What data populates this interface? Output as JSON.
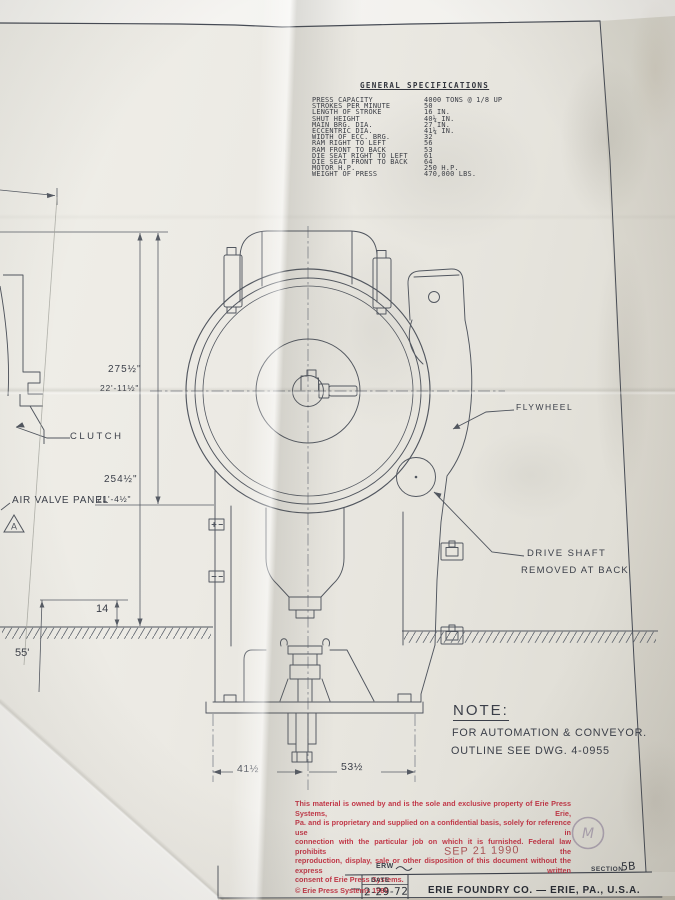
{
  "colors": {
    "paper": "#eceae4",
    "ink": "#4d525c",
    "legal_red": "#c23848",
    "stamp_red": "#a84a4c"
  },
  "specs": {
    "title": "GENERAL SPECIFICATIONS",
    "rows": [
      {
        "label": "PRESS CAPACITY",
        "value": "4000 TONS @ 1/8 UP"
      },
      {
        "label": "STROKES PER MINUTE",
        "value": "50"
      },
      {
        "label": "LENGTH OF STROKE",
        "value": "16 IN."
      },
      {
        "label": "SHUT HEIGHT",
        "value": "40¼ IN."
      },
      {
        "label": "MAIN BRG. DIA.",
        "value": "27 IN."
      },
      {
        "label": "ECCENTRIC DIA.",
        "value": "41¼ IN."
      },
      {
        "label": "WIDTH OF ECC. BRG.",
        "value": "32"
      },
      {
        "label": "RAM  RIGHT TO LEFT",
        "value": "56"
      },
      {
        "label": "RAM  FRONT TO BACK",
        "value": "53"
      },
      {
        "label": "DIE SEAT  RIGHT TO LEFT",
        "value": "61"
      },
      {
        "label": "DIE SEAT  FRONT TO BACK",
        "value": "64"
      },
      {
        "label": "MOTOR  H.P.",
        "value": "250 H.P."
      },
      {
        "label": "WEIGHT OF PRESS",
        "value": "470,000 LBS."
      }
    ]
  },
  "labels": {
    "clutch": "CLUTCH",
    "air_valve_panel": "AIR VALVE PANEL",
    "flywheel": "FLYWHEEL",
    "drive_shaft_line1": "DRIVE SHAFT",
    "drive_shaft_line2": "REMOVED AT BACK",
    "datum_a": "A"
  },
  "dimensions": {
    "height_total_in": "275½\"",
    "height_total_ft": "22'-11½\"",
    "height_upper_in": "254½\"",
    "height_upper_ft": "21'-4½\"",
    "pit_depth": "14",
    "left_depth": "55'",
    "bottom_left": "41½",
    "bottom_right": "53½"
  },
  "note": {
    "heading": "NOTE:",
    "line1": "FOR AUTOMATION & CONVEYOR.",
    "line2": "OUTLINE SEE DWG. 4-0955"
  },
  "legal": {
    "lines": [
      "This material is owned by and is the sole and exclusive property of Erie Press Systems, Erie,",
      "Pa. and is proprietary and supplied on a confidential basis, solely for reference use in",
      "connection with the particular job on which it is furnished. Federal law prohibits the",
      "reproduction, display, sale or other disposition of this document without the express written",
      "consent of Erie Press Systems."
    ],
    "copyright": "© Erie Press Systems 1989"
  },
  "stamp": {
    "date": "SEP 21 1990",
    "mark": "M"
  },
  "title_block": {
    "erw": "ERW",
    "section_label": "SECTION",
    "section_value": "5B",
    "date_label": "DATE",
    "date_value": "2-29-72",
    "company": "ERIE FOUNDRY CO. — ERIE, PA., U.S.A."
  }
}
